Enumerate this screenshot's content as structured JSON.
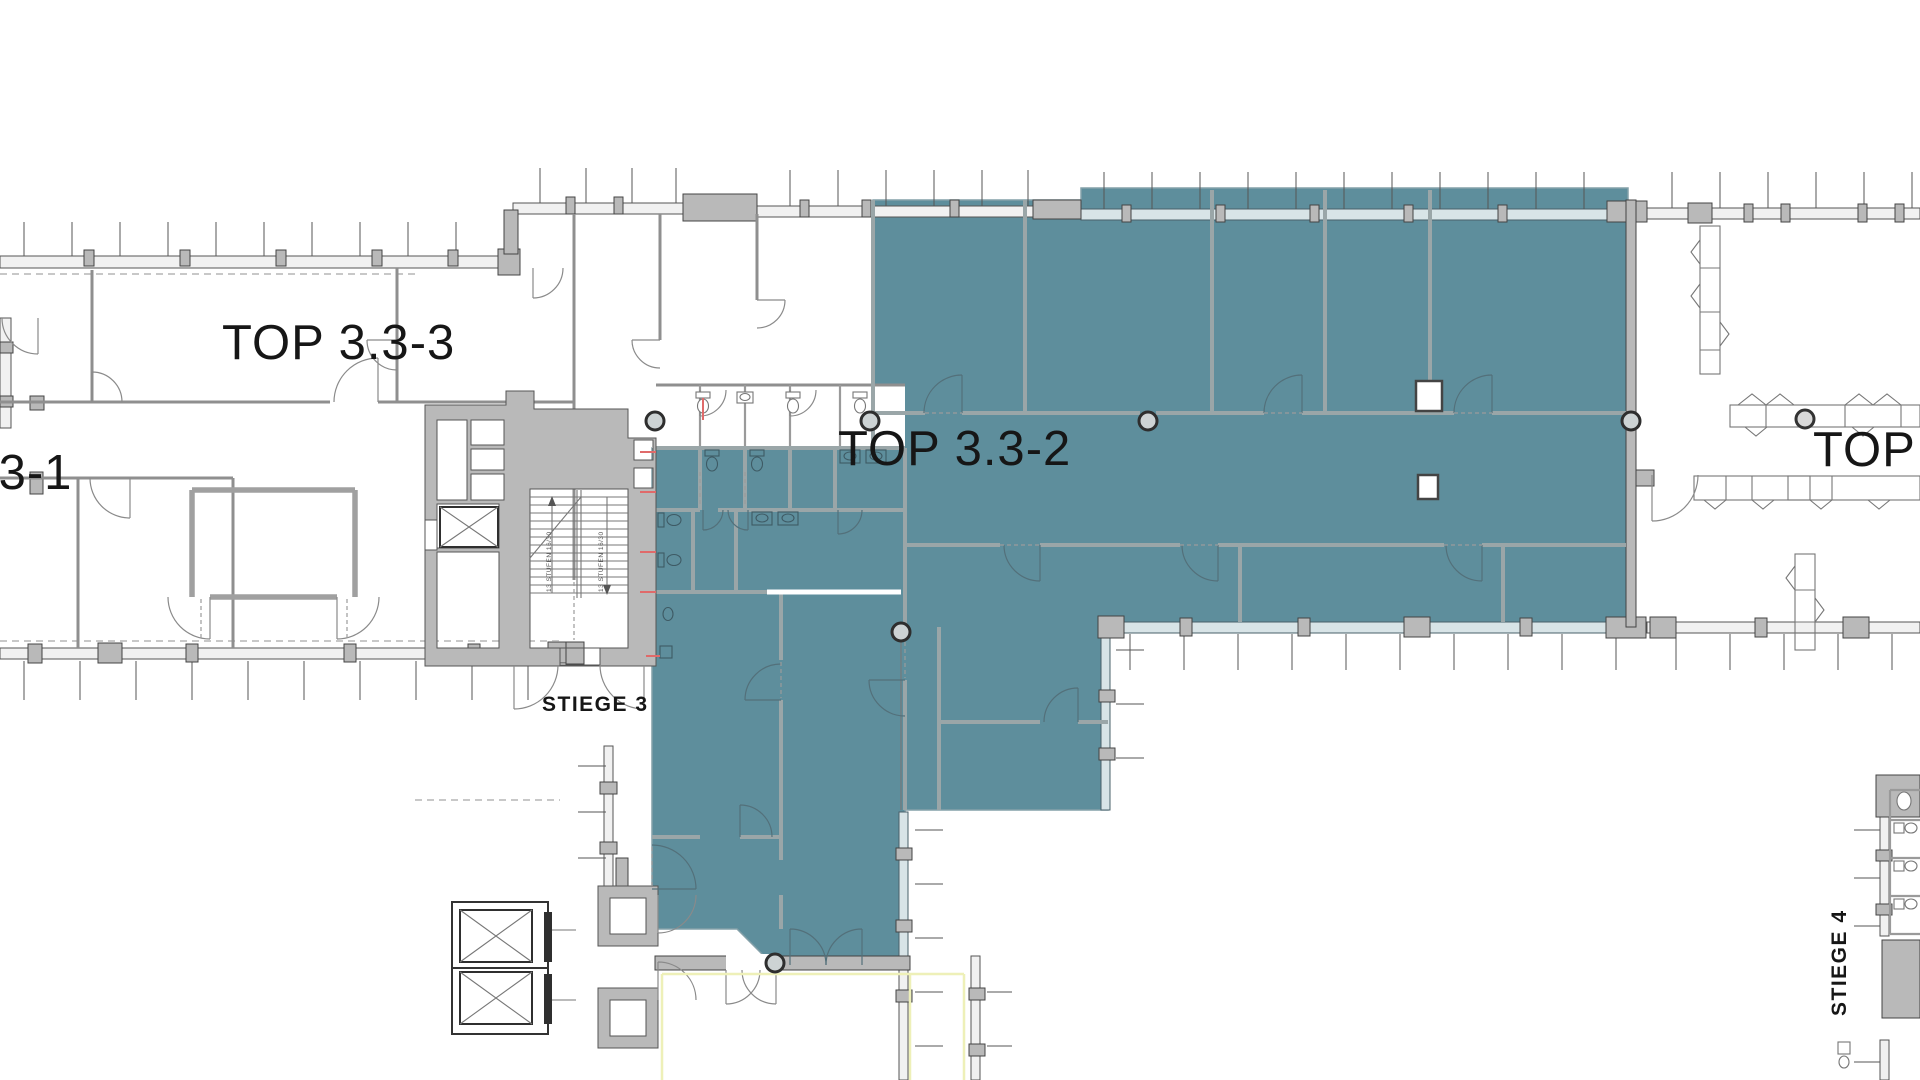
{
  "page": {
    "background": "#FFFFFF"
  },
  "plan": {
    "units": [
      {
        "id": "top-3-3-3",
        "label": "TOP 3.3-3",
        "highlighted": false
      },
      {
        "id": "top-3-3-2",
        "label": "TOP 3.3-2",
        "highlighted": true
      },
      {
        "id": "top-3-3-1",
        "label": ".3-1",
        "highlighted": false
      },
      {
        "id": "top-4",
        "label": "TOP 4",
        "highlighted": false
      }
    ],
    "stairwells": [
      {
        "id": "stiege-3",
        "label": "STIEGE 3"
      },
      {
        "id": "stiege-4",
        "label": "STIEGE 4"
      }
    ],
    "stair_note": "13 STUFEN 16/30",
    "colors": {
      "highlight_teal": "#5E8E9C",
      "teal_wall": "#9AA6A8",
      "wall_gray": "#B9B9B9",
      "accent_red": "#E06A6A",
      "accent_yellow": "#EEF0B8",
      "text": "#161616"
    }
  }
}
